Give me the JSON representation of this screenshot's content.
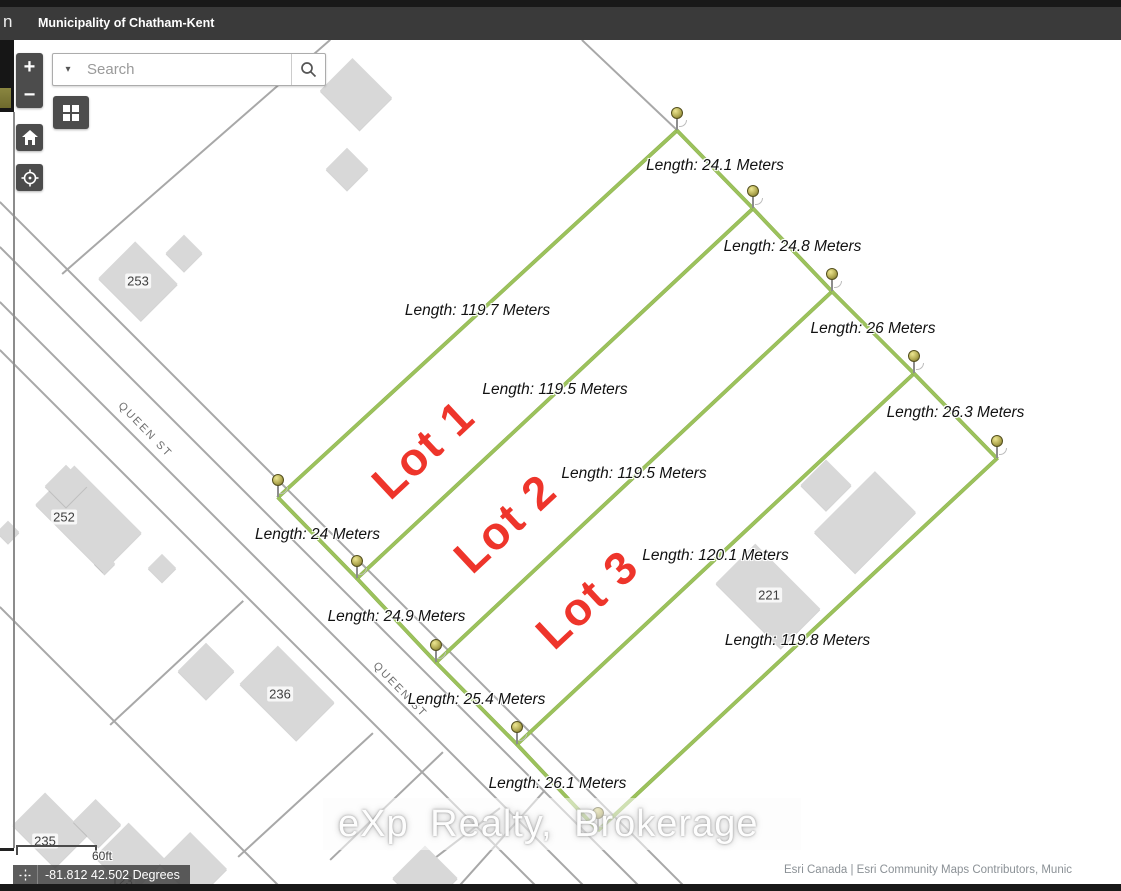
{
  "header": {
    "window_fragment": "n",
    "title": "Municipality of Chatham-Kent"
  },
  "search": {
    "placeholder": "Search"
  },
  "toolbar_icons": {
    "zoom_in": "+",
    "zoom_out": "−",
    "home": "home-icon",
    "locate": "locate-icon",
    "basemap": "basemap-grid-icon",
    "search_magnifier": "magnifier-icon",
    "dropdown_caret": "▾"
  },
  "map": {
    "street_labels": [
      {
        "text": "QUEEN ST",
        "x": 145,
        "y": 430,
        "rotation": 46
      },
      {
        "text": "QUEEN ST",
        "x": 400,
        "y": 690,
        "rotation": 46
      }
    ],
    "house_numbers": [
      {
        "text": "253",
        "x": 138,
        "y": 281
      },
      {
        "text": "252",
        "x": 64,
        "y": 517
      },
      {
        "text": "236",
        "x": 280,
        "y": 694
      },
      {
        "text": "221",
        "x": 769,
        "y": 595
      },
      {
        "text": "235",
        "x": 45,
        "y": 841
      },
      {
        "text": "123",
        "x": 122,
        "y": 881
      }
    ],
    "lot_labels": [
      {
        "text": "Lot 1",
        "x": 423,
        "y": 449
      },
      {
        "text": "Lot 2",
        "x": 505,
        "y": 523
      },
      {
        "text": "Lot 3",
        "x": 587,
        "y": 599
      }
    ],
    "measurement_color": "#9cc25c",
    "lot_label_color": "#ee352b",
    "measurement_segments": [
      {
        "x1": 278,
        "y1": 497,
        "x2": 677,
        "y2": 130,
        "label": "Length: 119.7 Meters"
      },
      {
        "x1": 357,
        "y1": 578,
        "x2": 753,
        "y2": 208,
        "label": "Length: 119.5 Meters"
      },
      {
        "x1": 436,
        "y1": 662,
        "x2": 832,
        "y2": 291,
        "label": "Length: 119.5 Meters"
      },
      {
        "x1": 517,
        "y1": 744,
        "x2": 914,
        "y2": 373,
        "label": "Length: 120.1 Meters"
      },
      {
        "x1": 598,
        "y1": 830,
        "x2": 997,
        "y2": 458,
        "label": "Length: 119.8 Meters"
      },
      {
        "x1": 677,
        "y1": 130,
        "x2": 753,
        "y2": 208,
        "label": "Length: 24.1 Meters"
      },
      {
        "x1": 753,
        "y1": 208,
        "x2": 832,
        "y2": 291,
        "label": "Length: 24.8 Meters"
      },
      {
        "x1": 832,
        "y1": 291,
        "x2": 914,
        "y2": 373,
        "label": "Length: 26 Meters"
      },
      {
        "x1": 914,
        "y1": 373,
        "x2": 997,
        "y2": 458,
        "label": "Length: 26.3 Meters"
      },
      {
        "x1": 278,
        "y1": 497,
        "x2": 357,
        "y2": 578,
        "label": "Length: 24 Meters"
      },
      {
        "x1": 357,
        "y1": 578,
        "x2": 436,
        "y2": 662,
        "label": "Length: 24.9 Meters"
      },
      {
        "x1": 436,
        "y1": 662,
        "x2": 517,
        "y2": 744,
        "label": "Length: 25.4 Meters"
      },
      {
        "x1": 517,
        "y1": 744,
        "x2": 598,
        "y2": 830,
        "label": "Length: 26.1 Meters"
      }
    ],
    "pins": [
      {
        "x": 278,
        "y": 497
      },
      {
        "x": 357,
        "y": 578
      },
      {
        "x": 436,
        "y": 662
      },
      {
        "x": 517,
        "y": 744
      },
      {
        "x": 598,
        "y": 830
      },
      {
        "x": 677,
        "y": 130
      },
      {
        "x": 753,
        "y": 208
      },
      {
        "x": 832,
        "y": 291
      },
      {
        "x": 914,
        "y": 373
      },
      {
        "x": 997,
        "y": 458
      }
    ]
  },
  "watermark": {
    "text": "eXp Realty, Brokerage"
  },
  "scale_bar": {
    "label": "60ft"
  },
  "coordinate_widget": {
    "text": "-81.812 42.502 Degrees"
  },
  "attribution": {
    "text": "Esri Canada | Esri Community Maps Contributors, Munic"
  }
}
